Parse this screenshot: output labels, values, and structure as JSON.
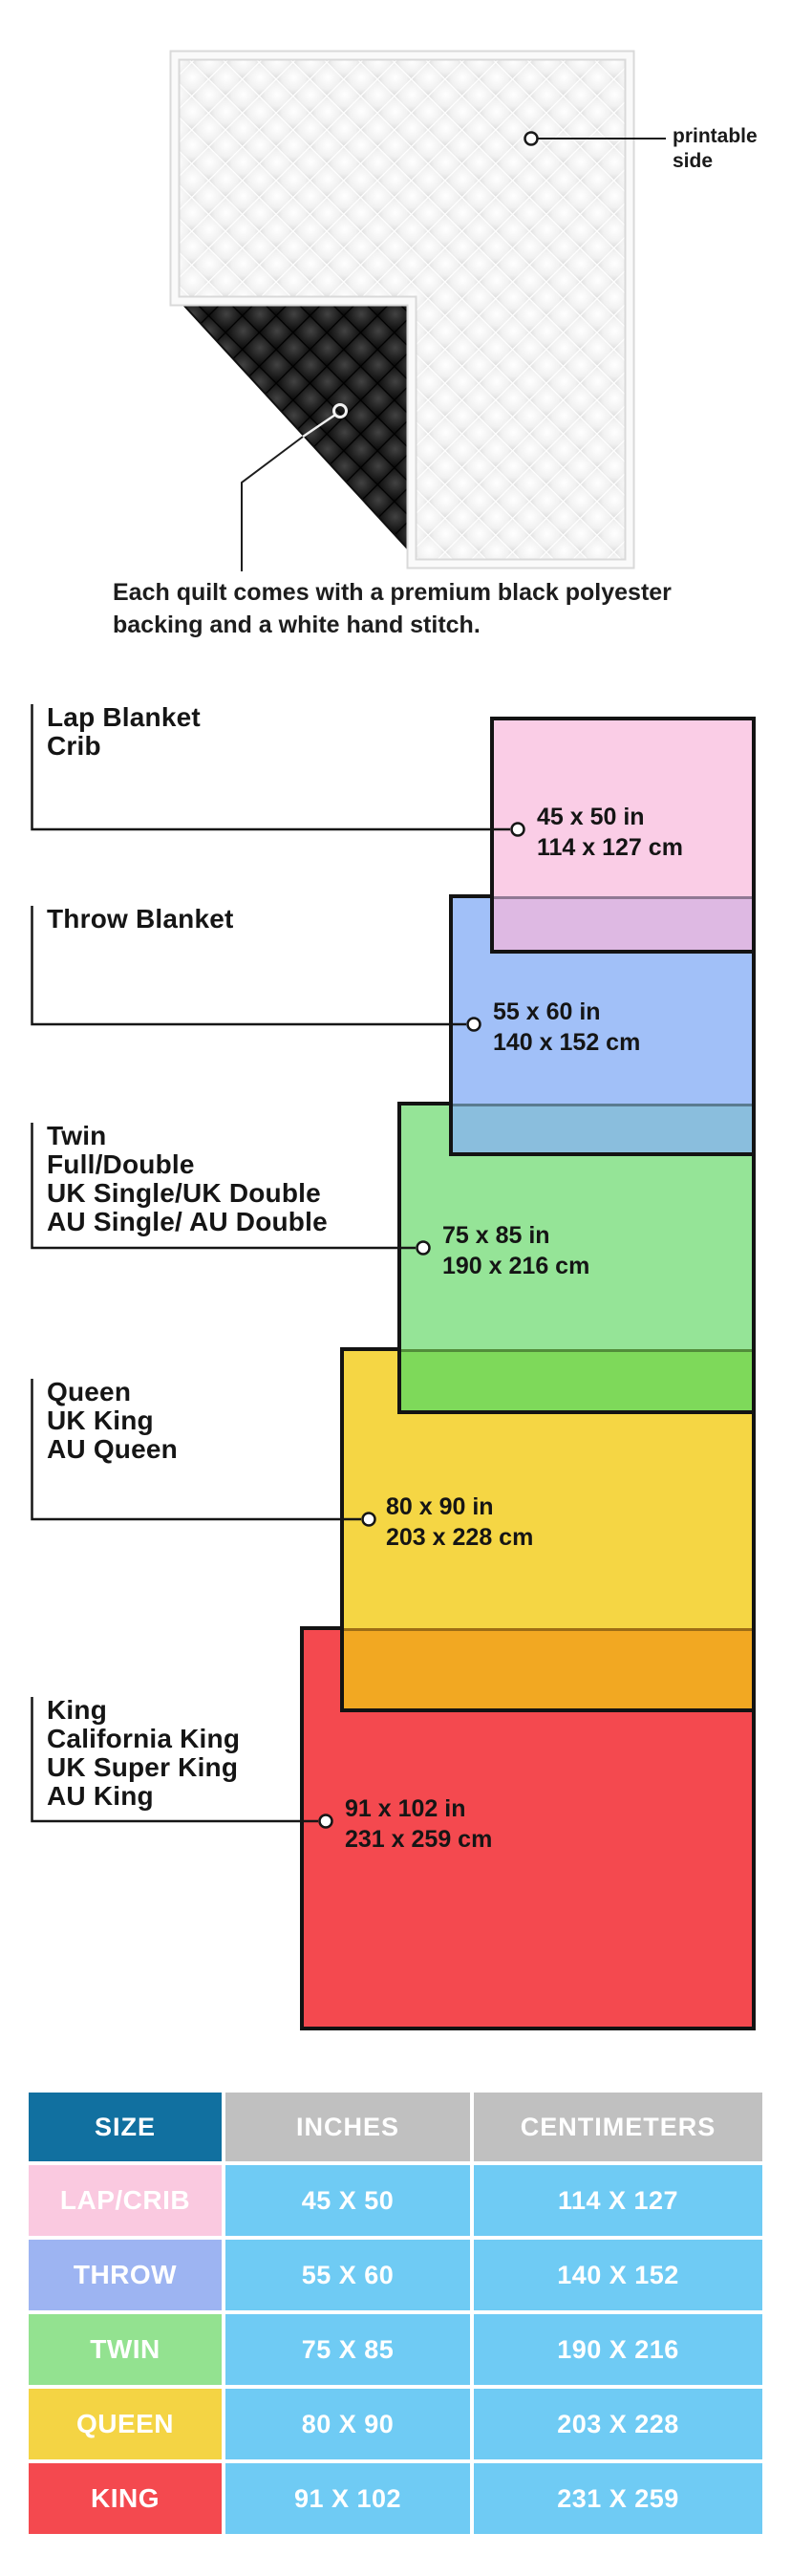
{
  "quilt": {
    "printable_label": "printable side",
    "caption": "Each quilt comes with a premium black polyester backing and a white hand stitch.",
    "front_color": "#f4f4f4",
    "backing_color": "#111111"
  },
  "styles": {
    "border_color": "#131313",
    "line_color": "#1a1a1a",
    "page_bg": "#ffffff"
  },
  "diagram": {
    "items": [
      {
        "labels": [
          "Lap Blanket",
          "Crib"
        ],
        "inches": "45 x 50 in",
        "cm": "114 x 127 cm",
        "fill": "#FACDE6",
        "overlap_fill": "#DEB9E3"
      },
      {
        "labels": [
          "Throw Blanket"
        ],
        "inches": "55 x 60 in",
        "cm": "140 x 152 cm",
        "fill": "#A1C0F8",
        "overlap_fill": "#8ABEDD"
      },
      {
        "labels": [
          "Twin",
          "Full/Double",
          "UK Single/UK Double",
          "AU Single/ AU Double"
        ],
        "inches": "75 x 85 in",
        "cm": "190 x 216 cm",
        "fill": "#95E497",
        "overlap_fill": "#7ED95A"
      },
      {
        "labels": [
          "Queen",
          "UK King",
          "AU Queen"
        ],
        "inches": "80 x 90 in",
        "cm": "203 x 228 cm",
        "fill": "#F5D644",
        "overlap_fill": "#F2A822"
      },
      {
        "labels": [
          "King",
          "California King",
          "UK Super King",
          "AU King"
        ],
        "inches": "91 x 102 in",
        "cm": "231 x 259 cm",
        "fill": "#F4494F",
        "overlap_fill": ""
      }
    ]
  },
  "table": {
    "headers": [
      "SIZE",
      "INCHES",
      "CENTIMETERS"
    ],
    "header_size_bg": "#1170A0",
    "header_other_bg": "#C0C0C0",
    "value_bg": "#6FCBF4",
    "rows": [
      {
        "size": "LAP/CRIB",
        "inches": "45 X 50",
        "cm": "114 X 127",
        "color": "#FAC9E0"
      },
      {
        "size": "THROW",
        "inches": "55 X 60",
        "cm": "140 X 152",
        "color": "#9DB4F2"
      },
      {
        "size": "TWIN",
        "inches": "75 X 85",
        "cm": "190 X 216",
        "color": "#93E290"
      },
      {
        "size": "QUEEN",
        "inches": "80 X 90",
        "cm": "203 X 228",
        "color": "#F4D444"
      },
      {
        "size": "KING",
        "inches": "91 X 102",
        "cm": "231 X 259",
        "color": "#F4494F"
      }
    ]
  }
}
